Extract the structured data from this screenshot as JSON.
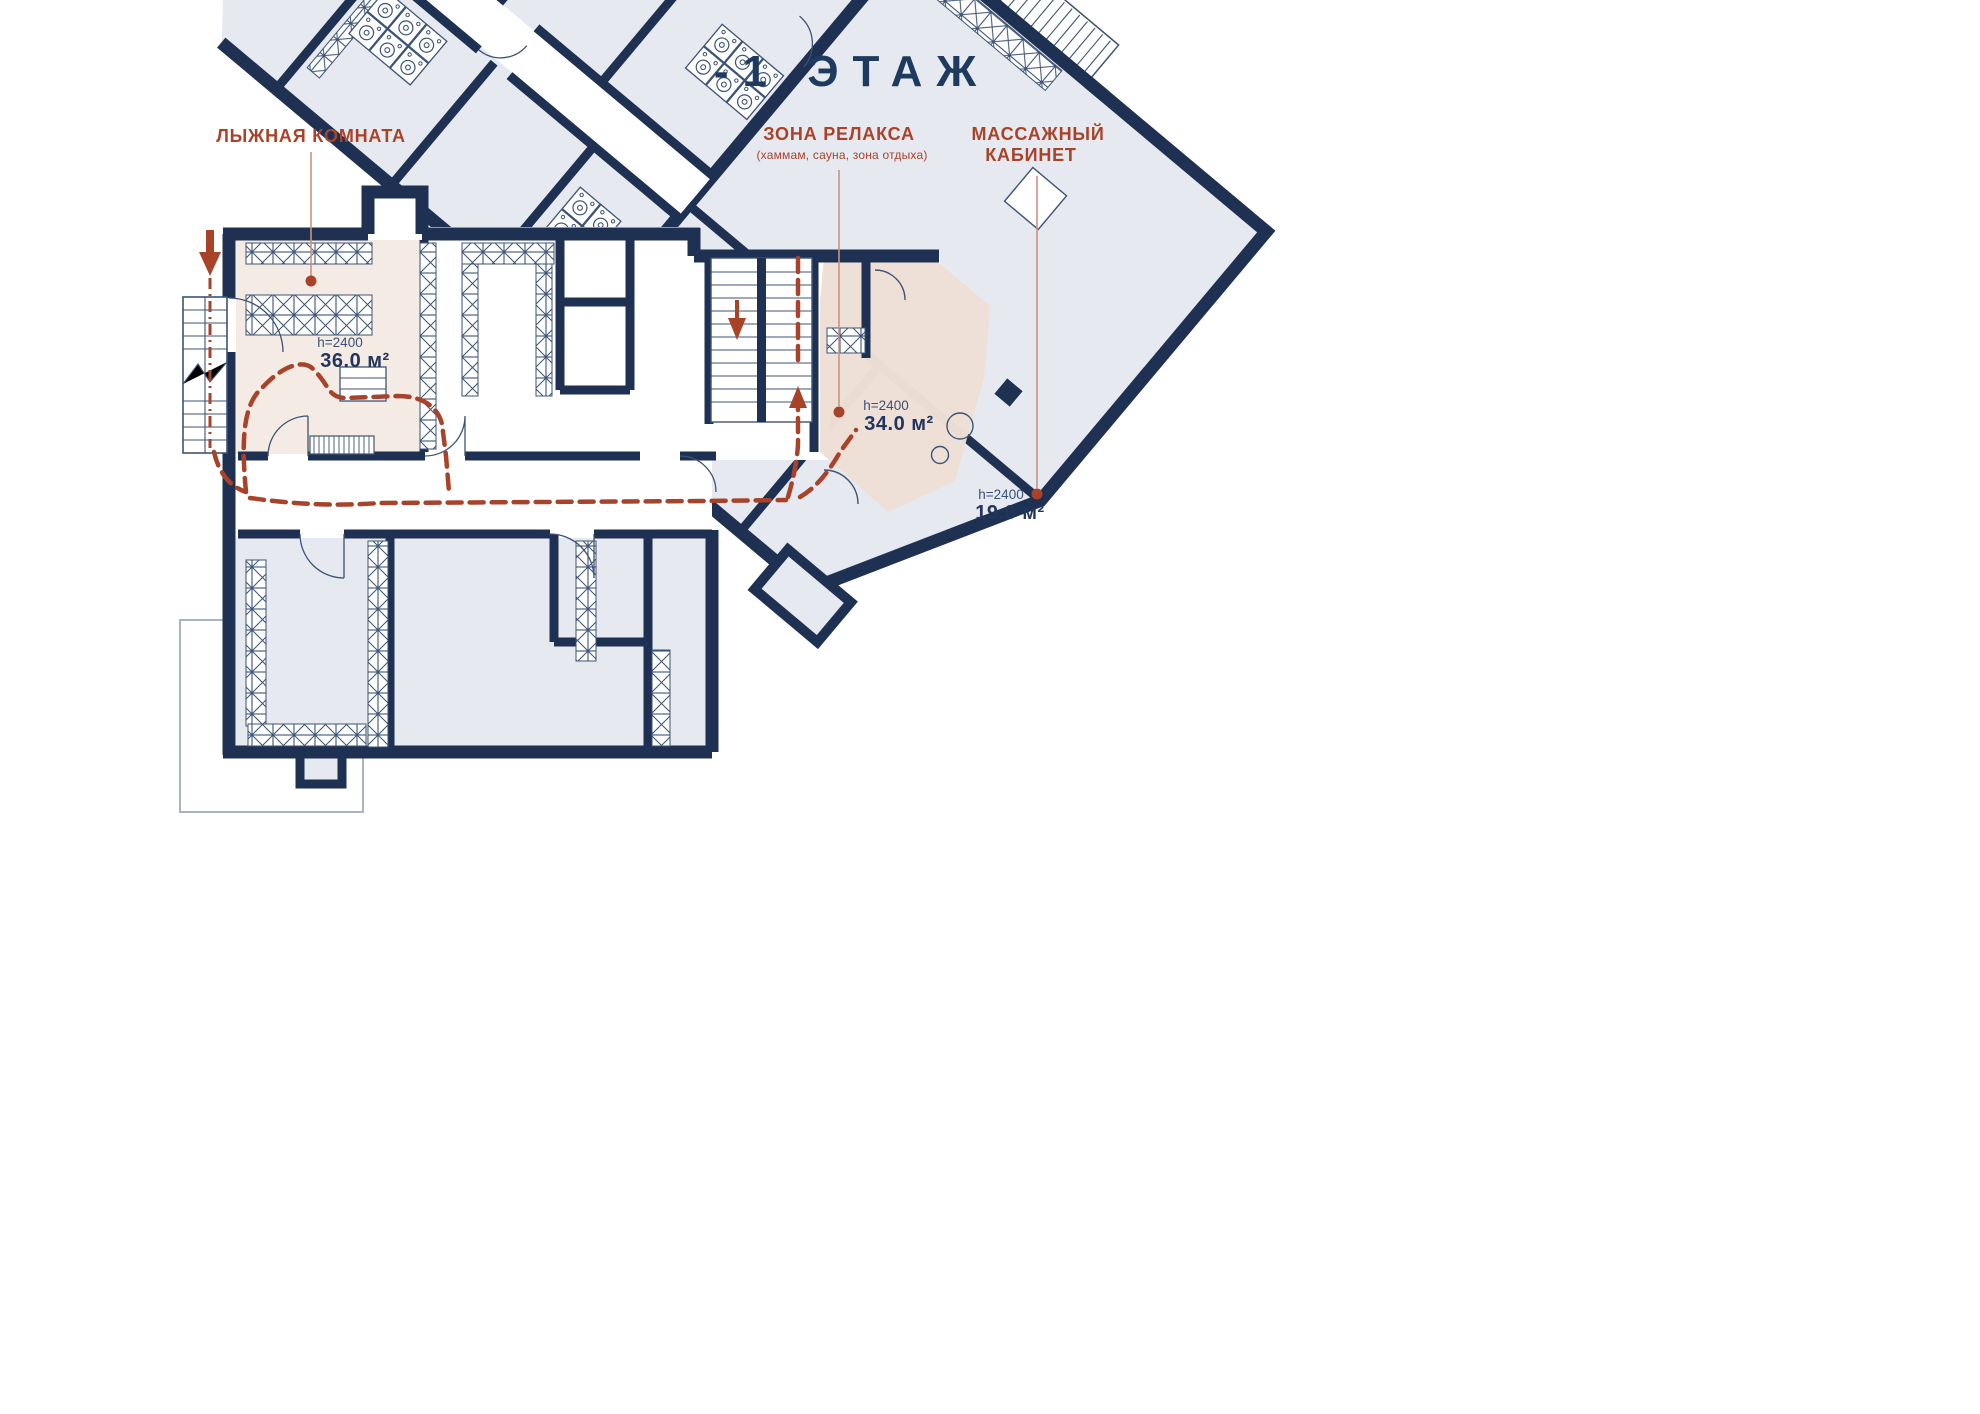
{
  "title": "-1 ЭТАЖ",
  "colors": {
    "wall": "#1e3153",
    "thin_line": "#3d5375",
    "room_fill": "#e6e9f0",
    "highlight_fill": "#efdfd6",
    "ski_fill": "#f5ebe5",
    "accent": "#a8432a"
  },
  "callouts": {
    "ski": {
      "label": "ЛЫЖНАЯ КОМНАТА",
      "height": "h=2400",
      "area": "36.0 м²"
    },
    "relax": {
      "label": "ЗОНА РЕЛАКСА",
      "sublabel": "(хаммам, сауна, зона отдыха)",
      "height": "h=2400",
      "area": "34.0 м²"
    },
    "massage": {
      "label_line1": "МАССАЖНЫЙ",
      "label_line2": "КАБИНЕТ",
      "height": "h=2400",
      "area": "19.0 м²"
    }
  }
}
